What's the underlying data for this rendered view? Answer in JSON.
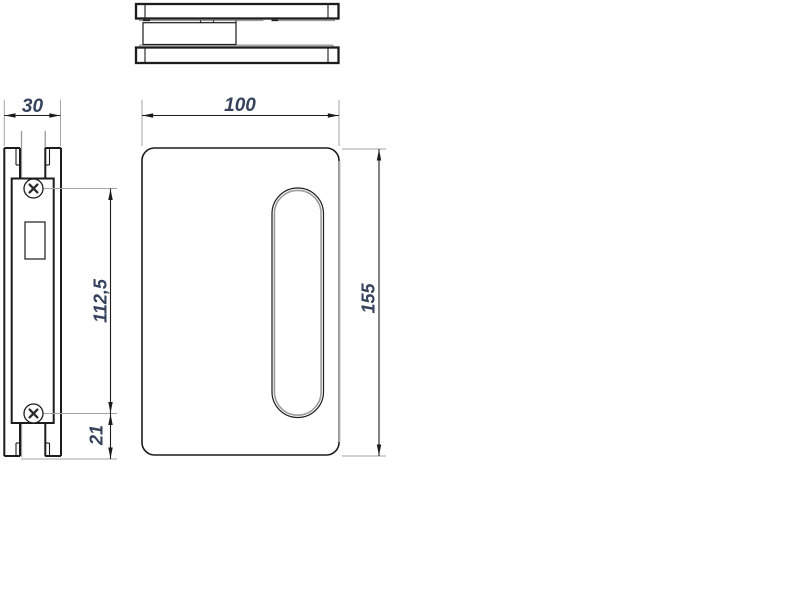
{
  "drawing": {
    "dim_labels": {
      "side_width": "30",
      "plate_width": "100",
      "plate_height": "155",
      "screw_span": "112,5",
      "bottom_offset": "21"
    },
    "colors": {
      "outline": "#1c1c1c",
      "auxiliary_gray": "#9a9a9a",
      "extension_gray": "#a3a3a3",
      "dim_text": "#35425c",
      "background": "#ffffff"
    }
  }
}
